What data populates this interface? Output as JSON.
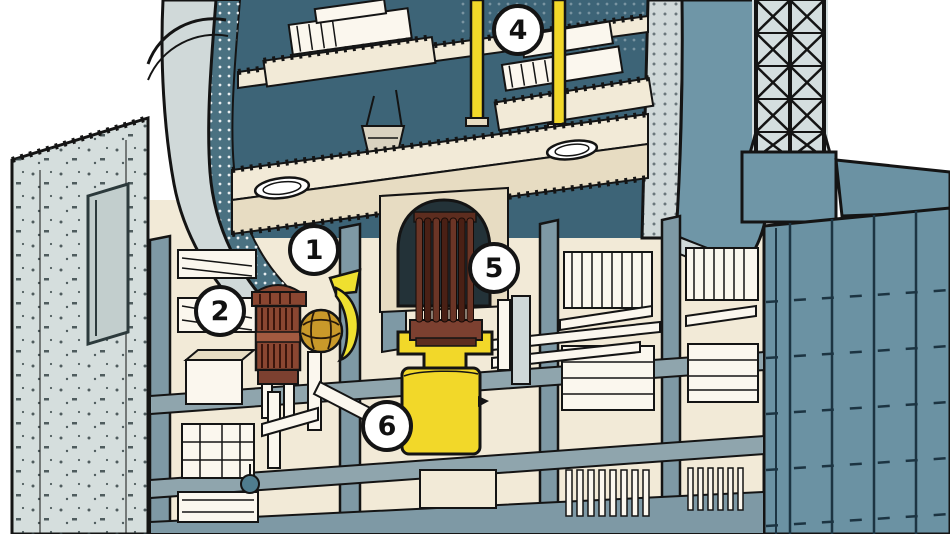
{
  "figure": {
    "type": "cutaway-diagram",
    "subject": "nuclear reactor containment building cutaway",
    "background": "#ffffff"
  },
  "callouts": {
    "items": [
      {
        "number": "1",
        "x": 314,
        "y": 250
      },
      {
        "number": "2",
        "x": 220,
        "y": 311
      },
      {
        "number": "4",
        "x": 518,
        "y": 30
      },
      {
        "number": "5",
        "x": 494,
        "y": 268
      },
      {
        "number": "6",
        "x": 387,
        "y": 426
      }
    ]
  },
  "palette": {
    "ink": "#141414",
    "pale_wall": "#d5dedd",
    "light_band": "#d0d9d9",
    "interior_teal": "#3d6477",
    "cut_edge_teal": "#4a7181",
    "shell_blue": "#6f96a7",
    "facade_blue": "#6b92a3",
    "partition_blue": "#7e99a5",
    "floor_band": "#8fa5ad",
    "cream": "#f2ead7",
    "cream_shadow": "#e7dcc2",
    "equipment_white": "#fbf7ee",
    "yellow": "#f2d829",
    "gold": "#c9992a",
    "brown": "#8a4631",
    "rod_brown": "#5d2d1f",
    "callout_fill": "#ffffff"
  }
}
